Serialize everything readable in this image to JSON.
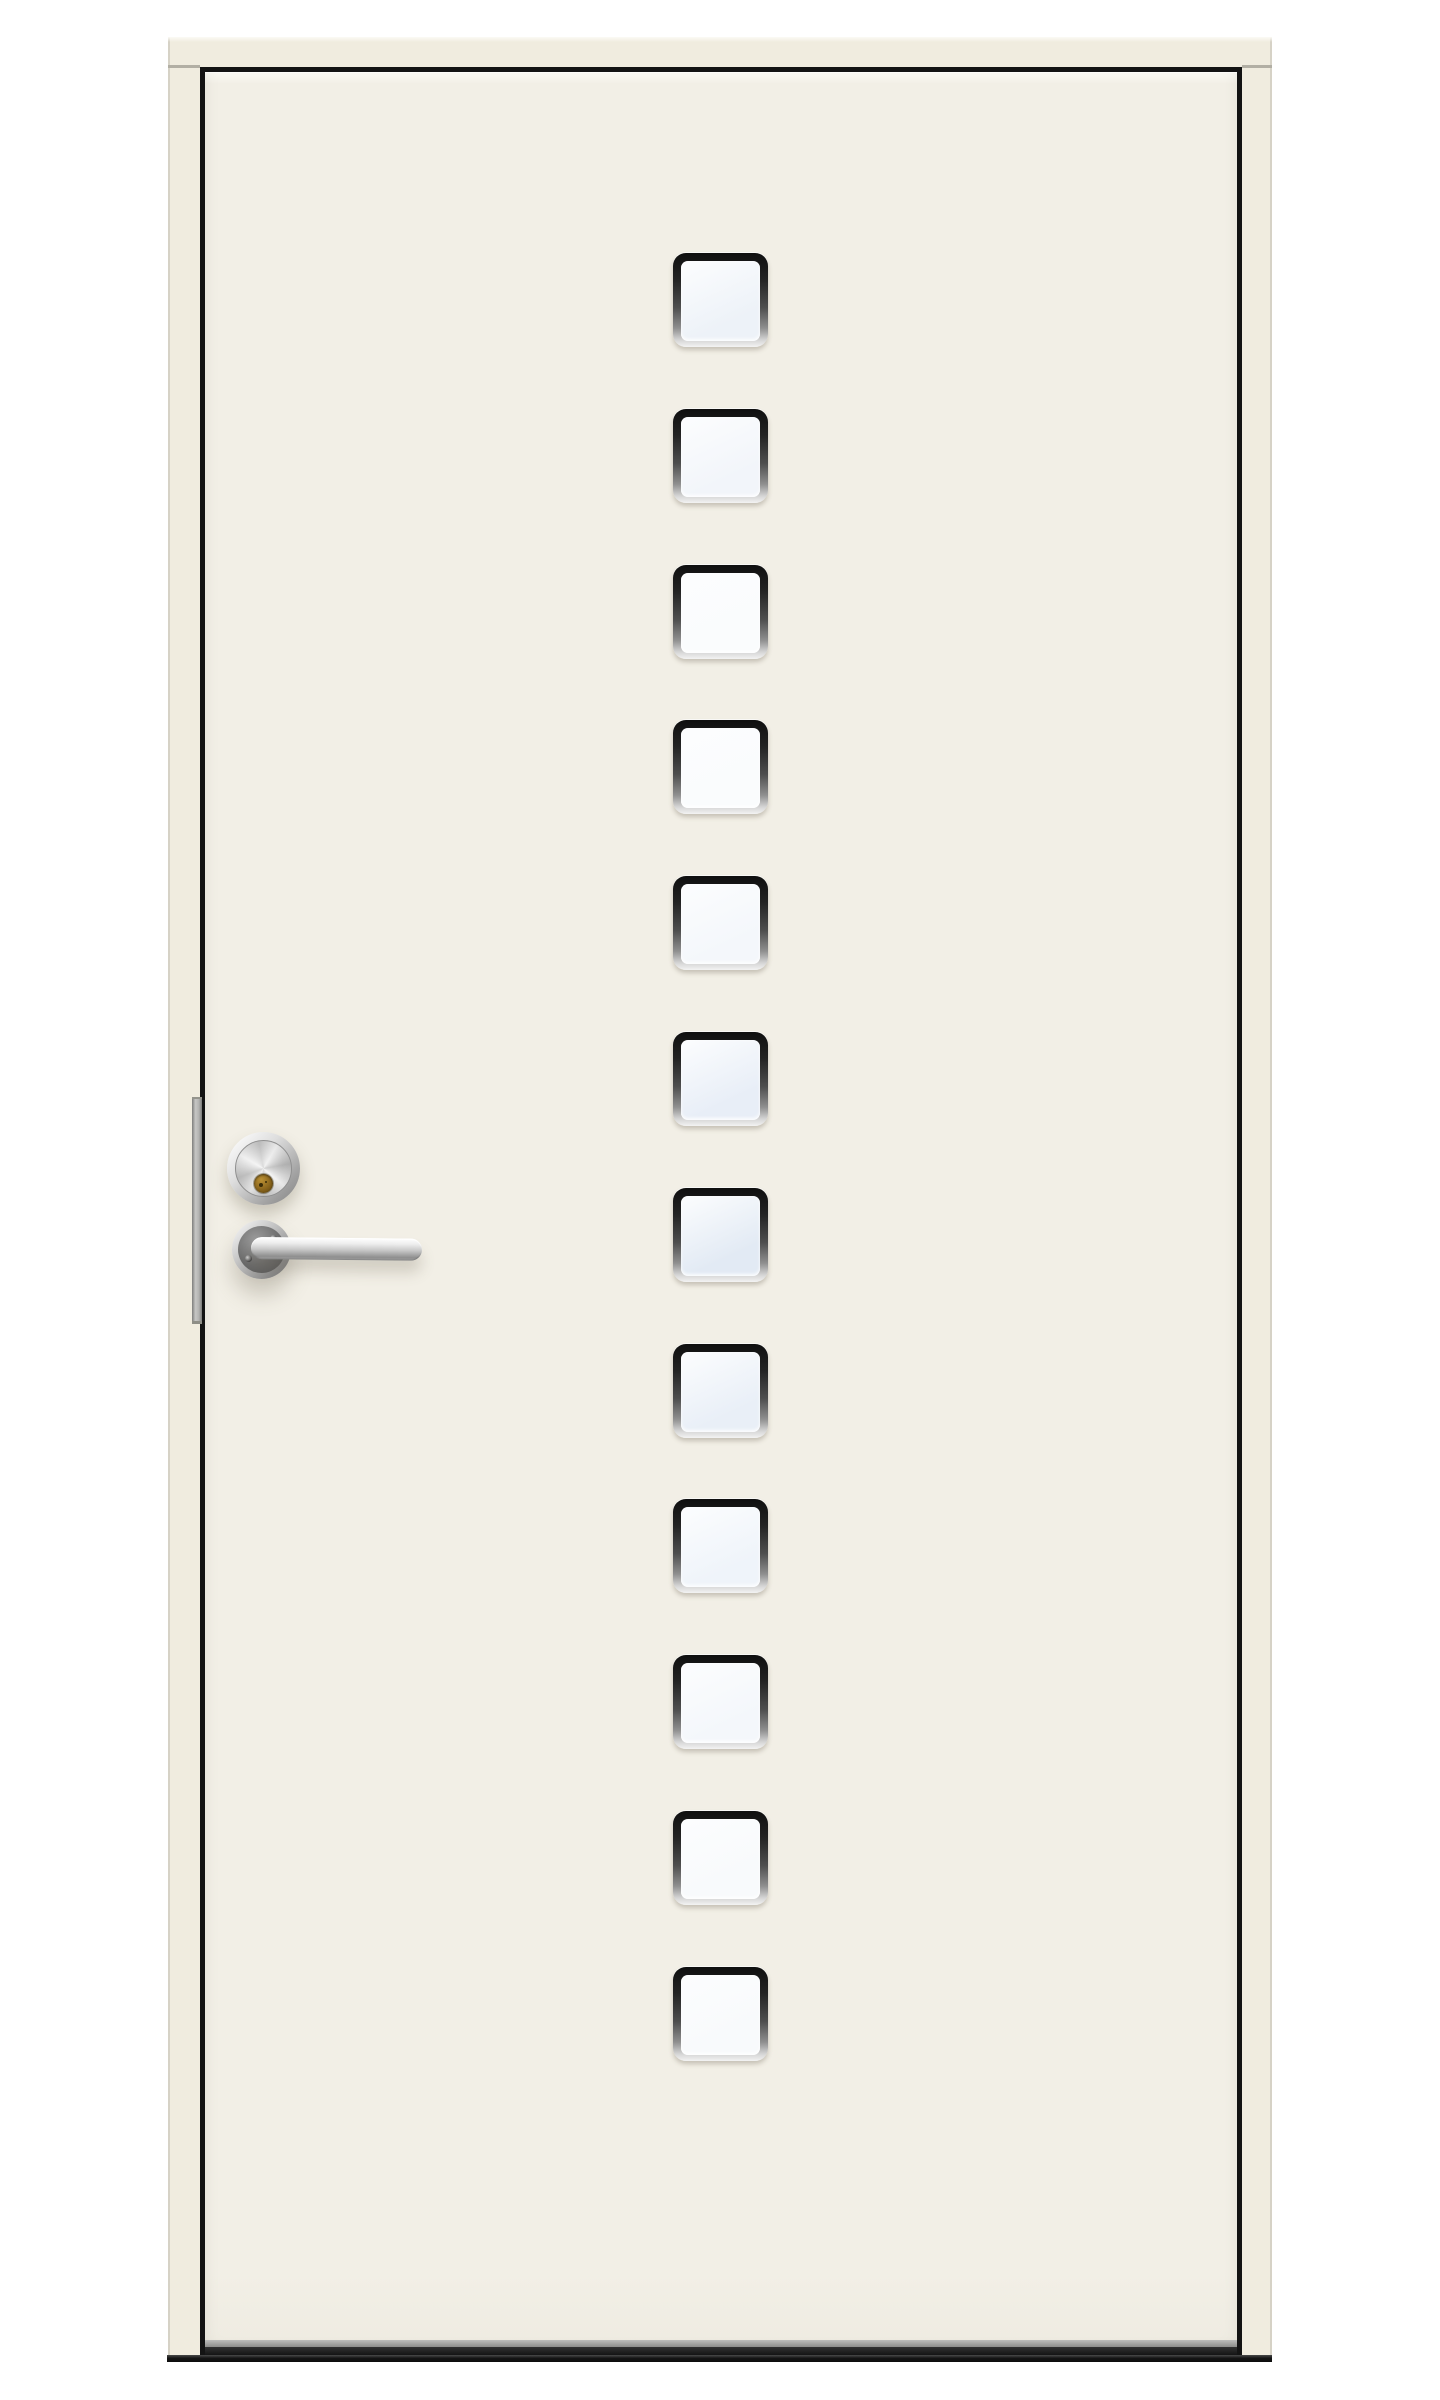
{
  "scene": {
    "type": "product-photo",
    "subject": "White exterior front door with a vertical column of twelve small square glass panes, stainless steel lever handle, lock cylinder and security strip, shown in a cream door frame on a white background",
    "background_color": "#ffffff"
  },
  "frame": {
    "color": "#f0ecdf",
    "edge_line_color": "#d6d2c6",
    "gap_color": "#131313"
  },
  "door": {
    "paint_color": "#f2efe6",
    "bottom_edge_color": "#9a9a98",
    "bottom_seal_color": "#1c1c1c",
    "window_frame_color": "#1a1a1a",
    "windows": [
      {
        "id": "window-1",
        "glass_tint": "#edf2f8"
      },
      {
        "id": "window-2",
        "glass_tint": "#f2f5fa"
      },
      {
        "id": "window-3",
        "glass_tint": "#fafcfd"
      },
      {
        "id": "window-4",
        "glass_tint": "#fafcfd"
      },
      {
        "id": "window-5",
        "glass_tint": "#f4f7fb"
      },
      {
        "id": "window-6",
        "glass_tint": "#e8eef7"
      },
      {
        "id": "window-7",
        "glass_tint": "#e2eaf4"
      },
      {
        "id": "window-8",
        "glass_tint": "#e9eff7"
      },
      {
        "id": "window-9",
        "glass_tint": "#eff4fa"
      },
      {
        "id": "window-10",
        "glass_tint": "#f4f7fb"
      },
      {
        "id": "window-11",
        "glass_tint": "#f8fafc"
      },
      {
        "id": "window-12",
        "glass_tint": "#f8fafc"
      }
    ],
    "windows_count": 12
  },
  "hardware": {
    "finish": "stainless-chrome",
    "metal_color": "#c6c6c6",
    "lock_cylinder": {
      "brass_color": "#8a651c"
    },
    "security_strip": {
      "color": "#b2b2b0"
    },
    "threshold": {
      "color": "#151515"
    }
  }
}
